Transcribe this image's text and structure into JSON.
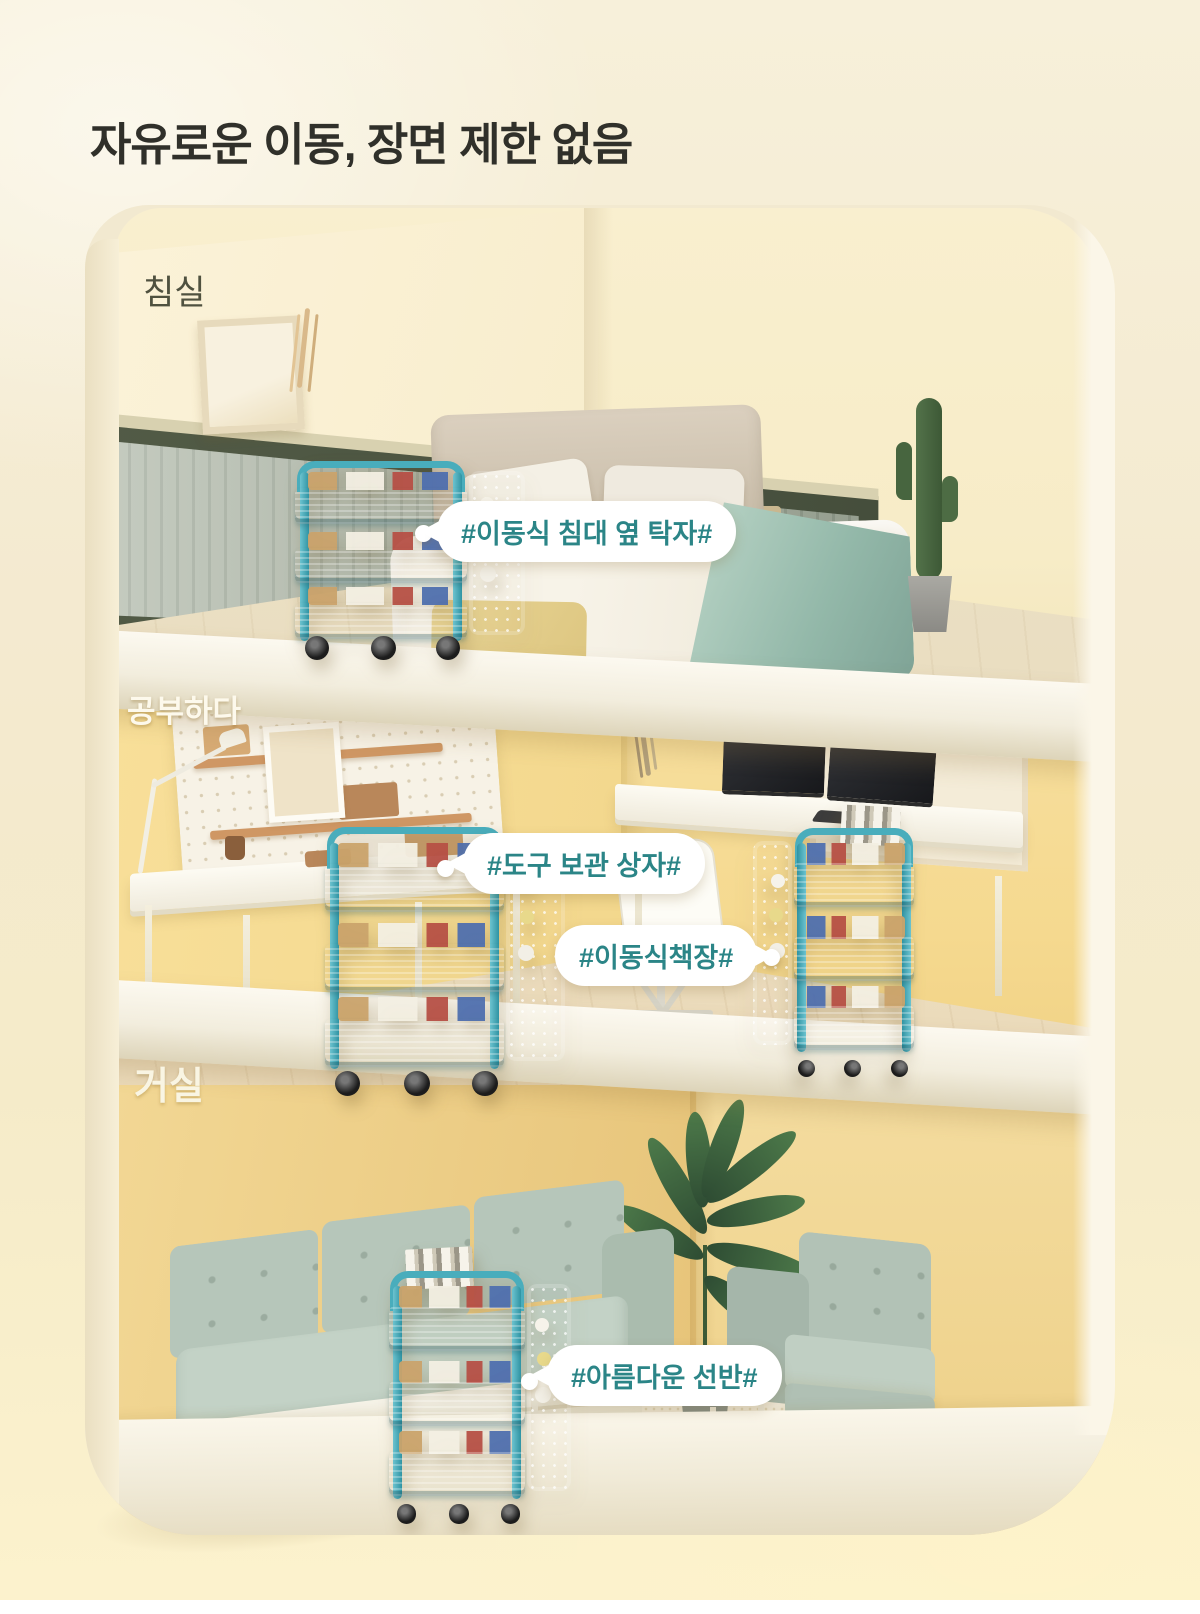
{
  "title": "자유로운 이동, 장면 제한 없음",
  "rooms": {
    "bedroom": {
      "label": "침실"
    },
    "study": {
      "label": "공부하다"
    },
    "living": {
      "label": "거실"
    }
  },
  "callouts": {
    "bedside_table": "#이동식 침대 옆 탁자#",
    "tool_storage": "#도구 보관 상자#",
    "mobile_bookshelf": "#이동식책장#",
    "beautiful_shelf": "#아름다운 선반#"
  },
  "colors": {
    "accent_teal": "#2b8587",
    "cart_teal": "#3fa9b8",
    "cart_teal_dark": "#2f93a3",
    "bg_cream": "#f5ecd2",
    "wall_yellow": "#f3d88e",
    "wainscot_green": "#4a5340",
    "sofa_sage": "#b6c6ba"
  }
}
